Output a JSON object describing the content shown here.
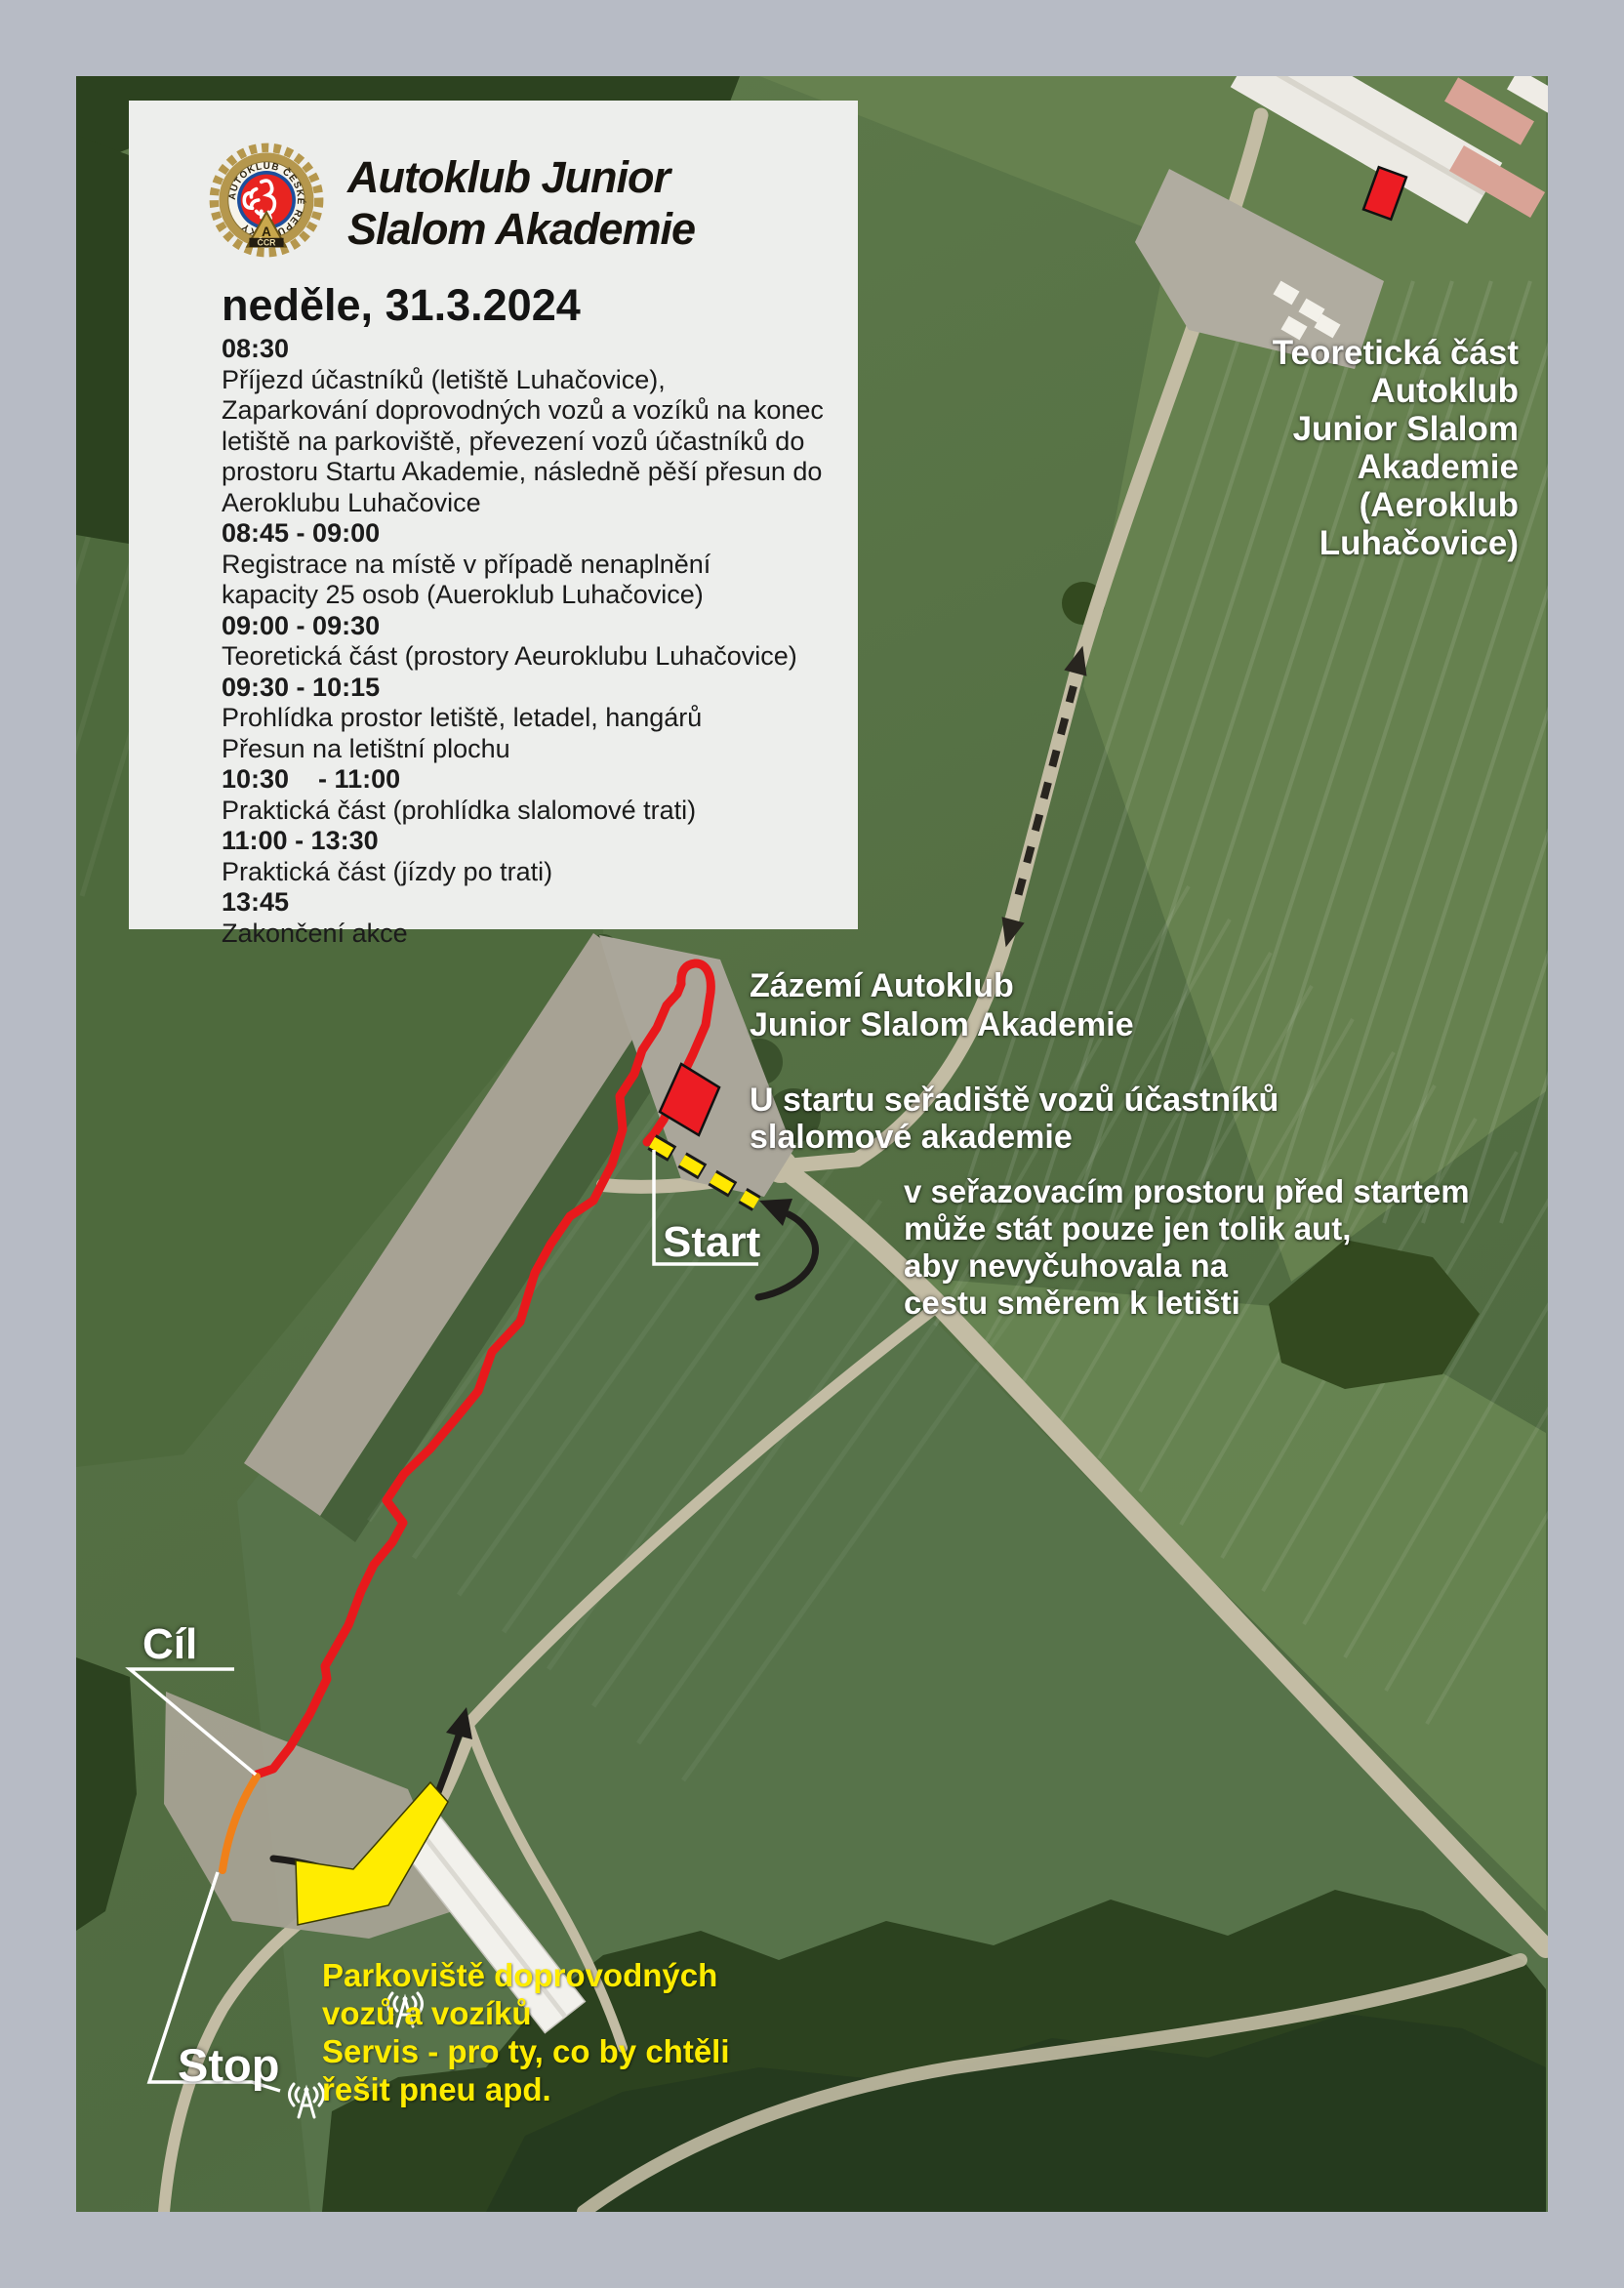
{
  "header": {
    "logo": {
      "ring_text": "AUTOKLUB ČESKÉ REPUBLIKY",
      "badge_letter": "A",
      "badge_text": "ČCR"
    },
    "title_line1": "Autoklub Junior",
    "title_line2": "Slalom Akademie"
  },
  "schedule": {
    "date": "neděle, 31.3.2024",
    "items": [
      {
        "t": "08:30",
        "b": true
      },
      {
        "t": "Příjezd účastníků (letiště Luhačovice),",
        "b": false
      },
      {
        "t": "Zaparkování doprovodných vozů a vozíků na konec",
        "b": false
      },
      {
        "t": "letiště na parkoviště, převezení vozů účastníků do",
        "b": false
      },
      {
        "t": "prostoru Startu Akademie, následně pěší přesun do",
        "b": false
      },
      {
        "t": "Aeroklubu Luhačovice",
        "b": false
      },
      {
        "t": "08:45 - 09:00",
        "b": true
      },
      {
        "t": "Registrace na místě v případě nenaplnění",
        "b": false
      },
      {
        "t": "kapacity 25 osob (Aueroklub Luhačovice)",
        "b": false
      },
      {
        "t": "09:00 - 09:30",
        "b": true
      },
      {
        "t": "Teoretická část (prostory Aeuroklubu Luhačovice)",
        "b": false
      },
      {
        "t": "09:30 - 10:15",
        "b": true
      },
      {
        "t": "Prohlídka prostor letiště, letadel, hangárů",
        "b": false
      },
      {
        "t": "Přesun na letištní plochu",
        "b": false
      },
      {
        "t": "10:30    - 11:00",
        "b": true
      },
      {
        "t": "Praktická část (prohlídka slalomové trati)",
        "b": false
      },
      {
        "t": "11:00 - 13:30",
        "b": true
      },
      {
        "t": "Praktická část (jízdy po trati)",
        "b": false
      },
      {
        "t": "13:45",
        "b": true
      },
      {
        "t": "Zakončení akce",
        "b": false
      }
    ]
  },
  "map_labels": {
    "theory": "Teoretická část\nAutoklub\nJunior Slalom\nAkademie\n(Aeroklub\nLuhačovice)",
    "base": "Zázemí Autoklub\nJunior Slalom Akademie",
    "start_area": "U startu seřadiště vozů účastníků\nslalomové akademie",
    "staging": "v seřazovacím prostoru před startem\nmůže stát pouze jen tolik aut,\naby nevyčuhovala na\ncestu směrem k letišti",
    "start": "Start",
    "finish": "Cíl",
    "stop": "Stop",
    "parking": "Parkoviště doprovodných\nvozů a vozíků\nServis - pro ty, co by chtěli\nřešit pneu apd."
  },
  "colors": {
    "track_red": "#e8191c",
    "marker_red": "#ec1c23",
    "route_yellow": "#ffe800",
    "parking_yellow": "#ffec00",
    "finish_orange": "#f08019",
    "frame_gray": "#b7bbc5"
  }
}
